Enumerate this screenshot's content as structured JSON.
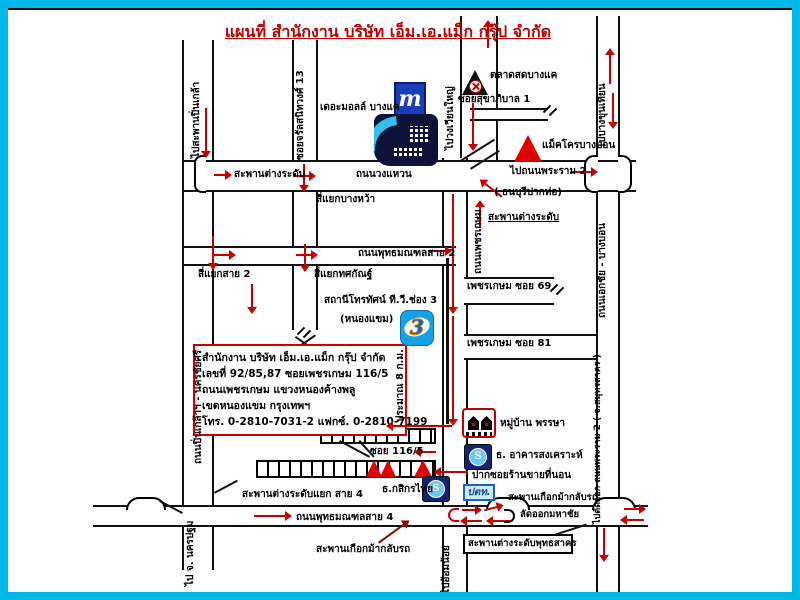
{
  "title": "แผนที่ สำนักงาน บริษัท เอ็ม.เอ.แม็ก กรุ๊ป จำกัด",
  "office_box": {
    "line1": "สำนักงาน บริษัท เอ็ม.เอ.แม็ก กรุ๊ป จำกัด",
    "line2": "เลขที่ 92/85,87 ซอยเพชรเกษม 116/5",
    "line3": "ถนนเพชรเกษม แขวงหนองค้างพลู",
    "line4": "เขตหนองแขม กรุงเทพฯ",
    "line5": "โทร. 0-2810-7031-2 แฟกซ์. 0-2810-7199"
  },
  "roads": {
    "wongwaen": "ถนนวงแหวน",
    "phetkasem": "ถนนเพชรเกษม",
    "sai2": "ถนนพุทธมณฑลสาย 2",
    "sai4": "ถนนพุทธมณฑลสาย 4",
    "charan13": "ซอยจรัลสนิทวงศ์ 13",
    "sukhaphiban1": "ซอยสุขาภิบาล 1",
    "soi69": "เพชรเกษม ซอย 69",
    "soi81": "เพชรเกษม ซอย 81",
    "soi116_5": "ซอย 116/5",
    "ekkachai_bangbon": "ถนนเอกชัย - บางบอน",
    "pinklao_nakhonchaisi": "ถนนปิ่นเกล้าฯ - นครชัยศรี"
  },
  "directions": {
    "pinklao": "ไปสะพานปิ่นเกล้า",
    "wongwian_yai": "ไปวงเวียนใหญ่",
    "bang_khun_thian": "ไปบางขุนเทียน",
    "rama2": "ไปถนนพระราม 2",
    "thonburi_pak_tho": "( ธนบุรีปากท่อ)",
    "rama2_exit": "ไปตัดออก ถนนพระราม 2 ( จ.สมุทรสาคร )",
    "nakhon_pathom": "ไป จ. นครปฐม",
    "om_noi": "ไปอ้อมน้อย",
    "mahachai": "ลัดออกมหาชัย",
    "distance_8km": "ประมาณ 8 ก.ม."
  },
  "junctions": {
    "interchange_left": "สะพานต่างระดับ",
    "interchange_right": "สะพานต่างระดับ",
    "bang_wa": "สี่แยกบางหว้า",
    "sai2_int": "สี่แยกสาย 2",
    "totsakan": "สี่แยกทศกัณฐ์",
    "sai4_int": "สะพานต่างระดับแยก สาย 4",
    "phutthasakhon": "สะพานต่างระดับพุทธสาคร",
    "horseshoe_left": "สะพานเกือกม้ากลับรถ",
    "horseshoe_right": "สะพานเกือกม้ากลับรถ"
  },
  "landmarks": {
    "the_mall": "เดอะมอลล์ บางแค",
    "mall_logo": "m",
    "market": "ตลาดสดบางแค",
    "makro": "แม็คโครบางบอน",
    "ch3_station": "สถานีโทรทัศน์ ที.วี.ช่อง 3",
    "nong_khaem": "(หนองแขม)",
    "ch3_logo": "3",
    "phansa_village": "หมู่บ้าน พรรษา",
    "ghb_bank": "ธ. อาคารสงเคราะห์",
    "kbank": "ธ.กสิกรไทย",
    "ptt": "ปตท.",
    "mattress_shop": "ปากซอยร้านขายที่นอน",
    "bank_symbol": "S"
  },
  "colors": {
    "frame": "#00b8e8",
    "accent_red": "#c90000",
    "logo_blue": "#1b3eb8"
  }
}
